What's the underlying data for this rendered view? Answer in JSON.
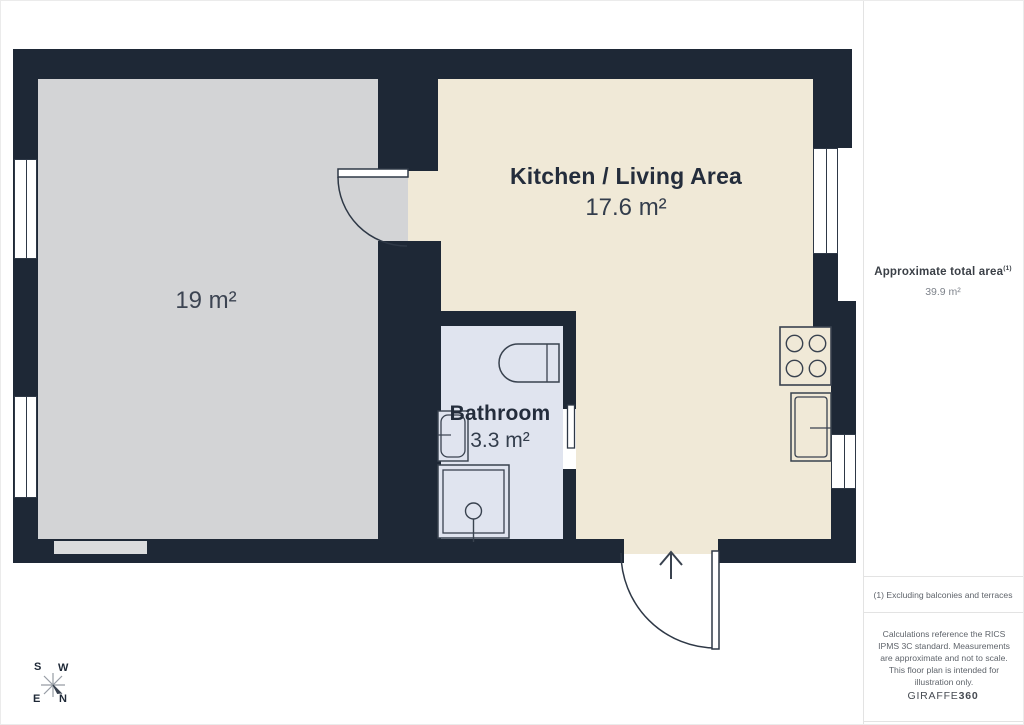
{
  "plan": {
    "rooms": [
      {
        "id": "living-room",
        "label": "",
        "area": "19 m²"
      },
      {
        "id": "kitchen-living-area",
        "label": "Kitchen / Living Area",
        "area": "17.6 m²"
      },
      {
        "id": "bathroom",
        "label": "Bathroom",
        "area": "3.3 m²"
      }
    ],
    "compass": {
      "s": "S",
      "w": "W",
      "e": "E",
      "n": "N"
    },
    "icons": [
      "stove-icon",
      "kitchen-sink-icon",
      "toilet-icon",
      "bathroom-sink-icon",
      "shower-icon",
      "entry-arrow-icon",
      "compass-icon"
    ]
  },
  "sidebar": {
    "total_area_label": "Approximate total area",
    "total_area_superscript": "(1)",
    "total_area_value": "39.9 m²",
    "footnote": "(1) Excluding balconies and terraces",
    "disclaimer": "Calculations reference the RICS IPMS 3C standard. Measurements are approximate and not to scale. This floor plan is intended for illustration only.",
    "brand_name": "GIRAFFE",
    "brand_suffix": "360"
  },
  "colors": {
    "wall": "#1e2836",
    "living_floor": "#d3d4d6",
    "kitchen_floor": "#f0e9d7",
    "bathroom_floor": "#e0e4ef",
    "outline": "#39424f",
    "text_dark": "#242d3c",
    "sidebar_text": "#5f646b"
  }
}
